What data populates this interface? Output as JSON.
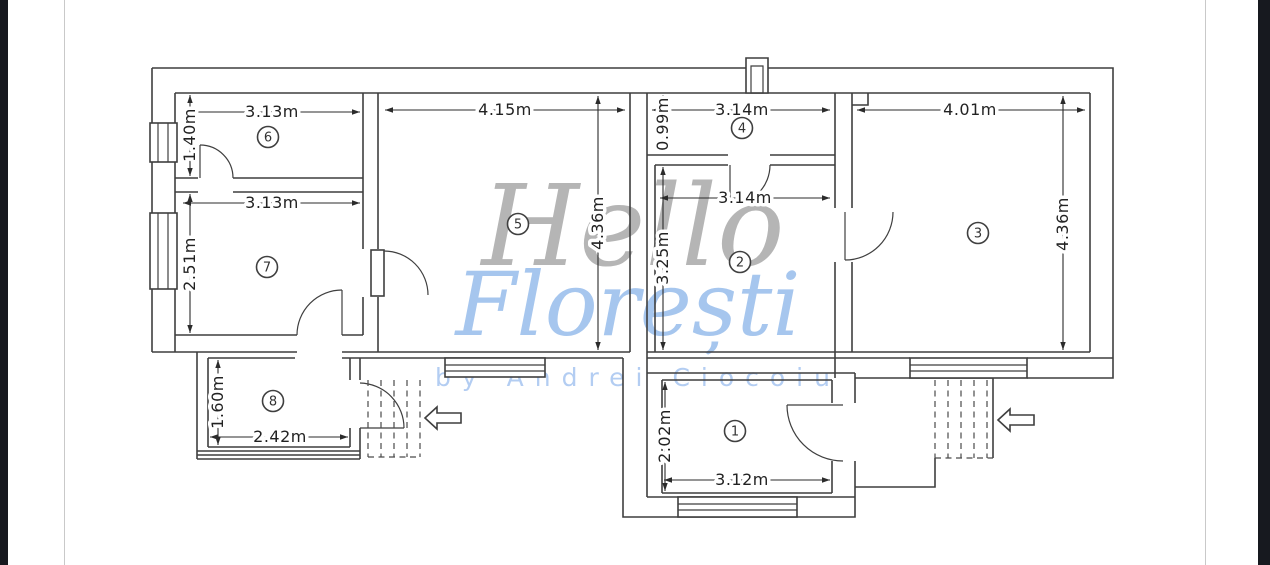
{
  "page": {
    "background": "#ffffff",
    "side_bar_color": "#17191f",
    "page_edge_color": "#c9c9c9"
  },
  "watermark": {
    "line1": "Hello",
    "line2": "Florești",
    "byline": "by Andrei Ciocoiu",
    "line1_color": "#b5b5b5",
    "line2_color": "#a6c6ee",
    "byline_color": "#b3cdf2"
  },
  "plan": {
    "wall_color": "#3f3f3f",
    "dimension_text_color": "#222222",
    "rooms": {
      "1": {
        "number": "1",
        "width": "3.12m",
        "height": "2.02m"
      },
      "2": {
        "number": "2",
        "width": "3.14m",
        "height": "3.25m"
      },
      "3": {
        "number": "3",
        "width": "4.01m",
        "height": "4.36m"
      },
      "4": {
        "number": "4",
        "width": "3.14m",
        "height": "0.99m"
      },
      "5": {
        "number": "5",
        "width": "4.15m",
        "height": "4.36m"
      },
      "6": {
        "number": "6",
        "width": "3.13m",
        "height": "1.40m"
      },
      "7": {
        "number": "7",
        "width": "3.13m",
        "height": "2.51m"
      },
      "8": {
        "number": "8",
        "width": "2.42m",
        "height": "1.60m"
      }
    }
  }
}
